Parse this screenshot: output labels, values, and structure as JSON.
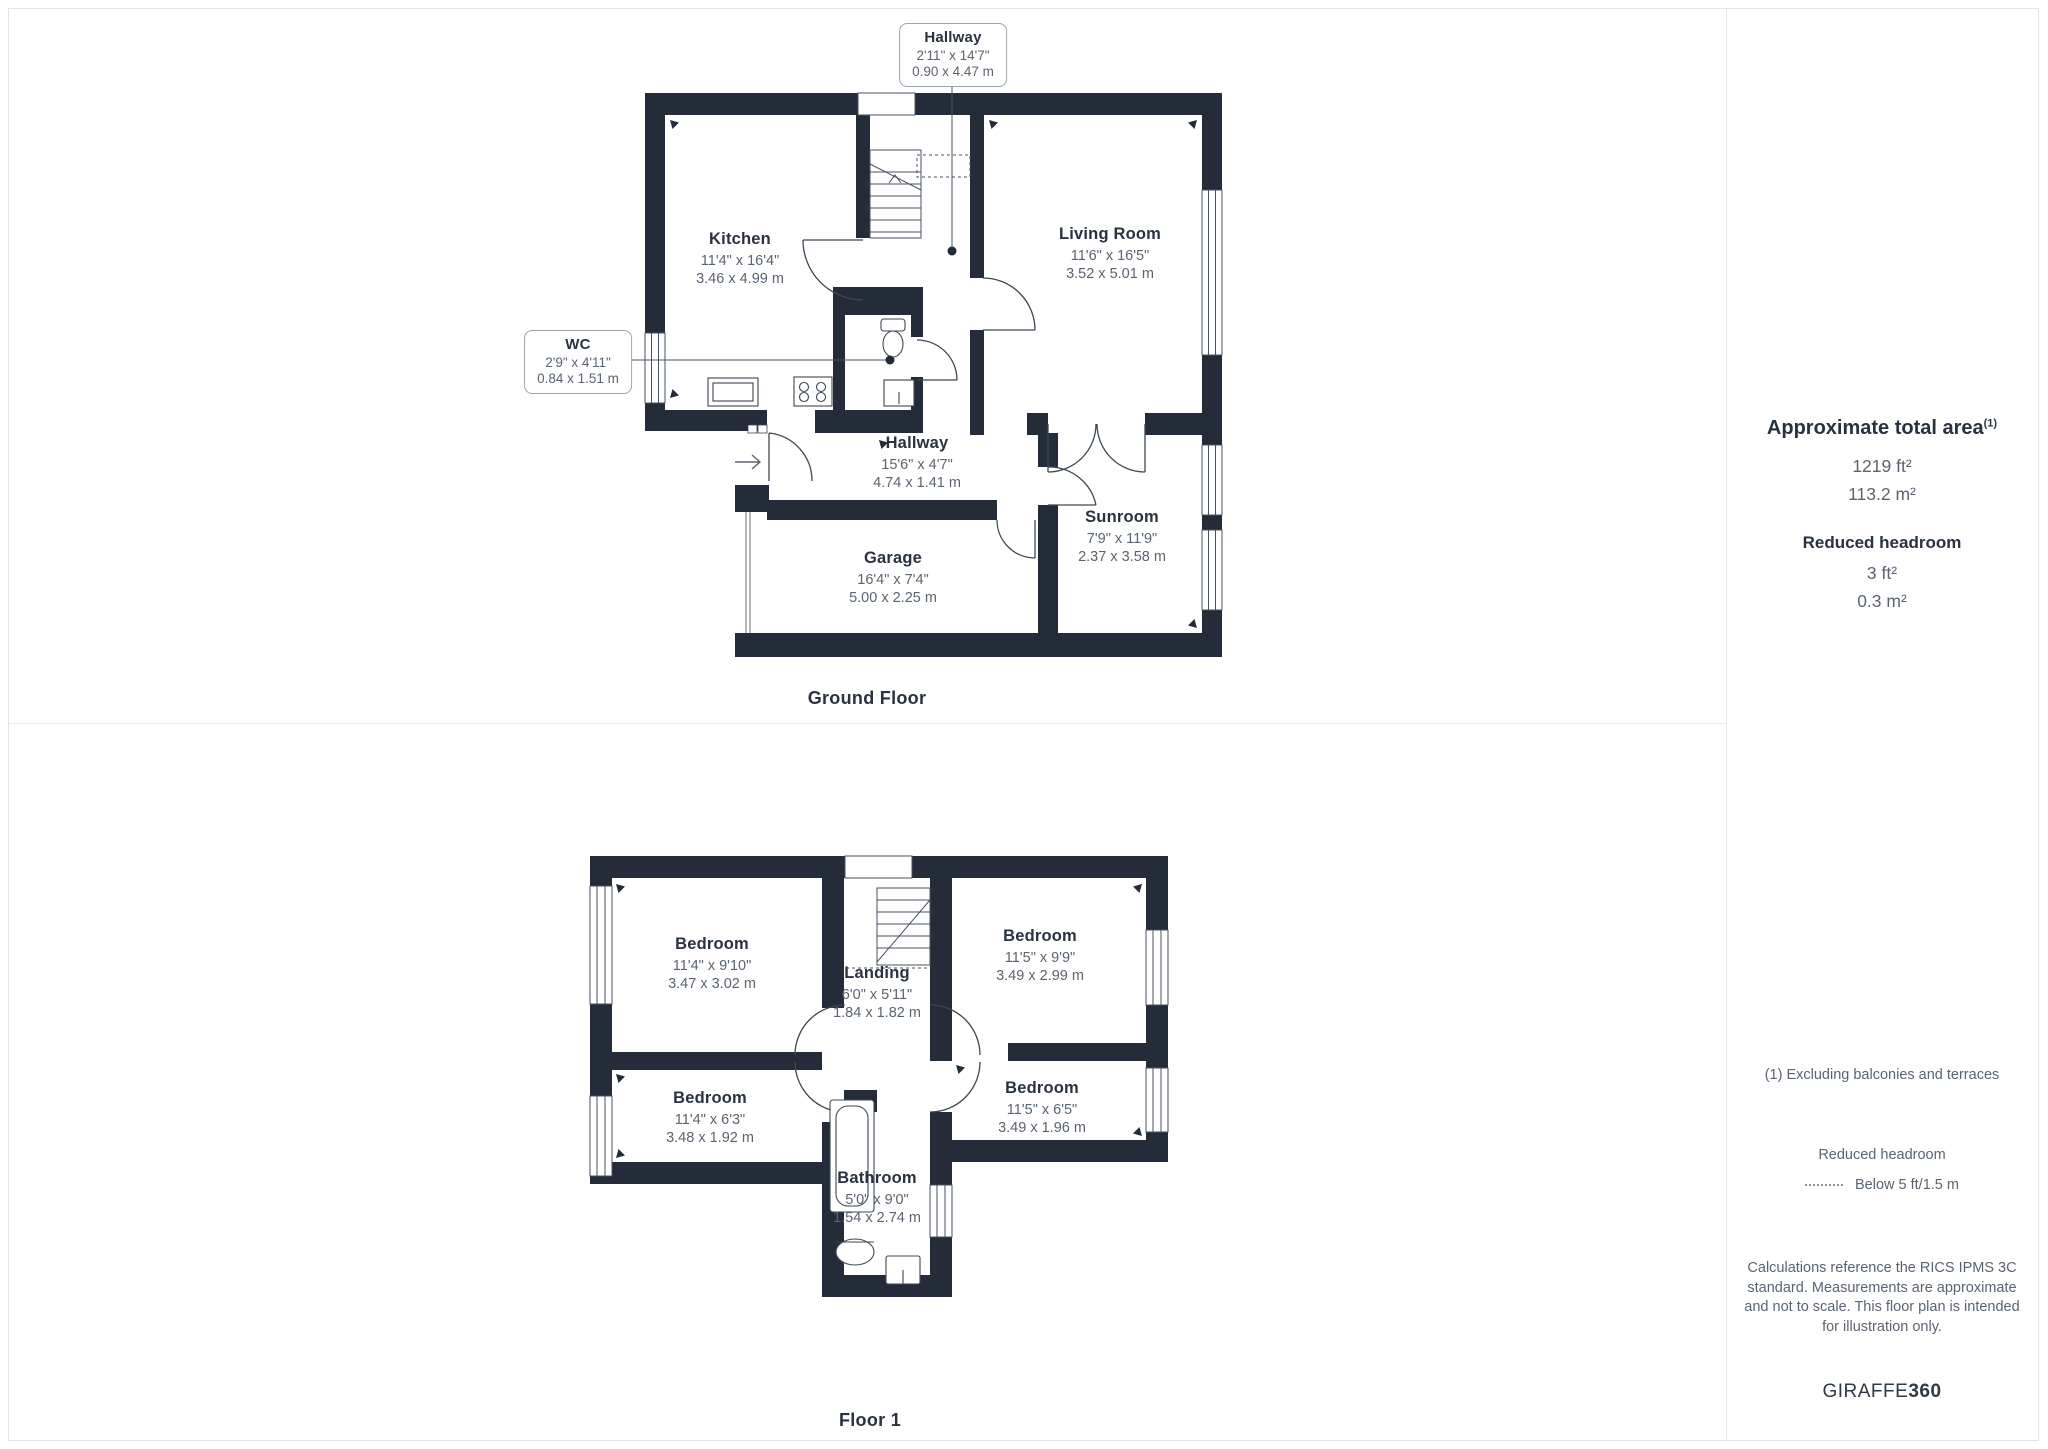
{
  "ground_floor": {
    "title": "Ground Floor",
    "rooms": {
      "kitchen": {
        "name": "Kitchen",
        "imperial": "11'4\" x 16'4\"",
        "metric": "3.46 x 4.99 m"
      },
      "living_room": {
        "name": "Living Room",
        "imperial": "11'6\" x 16'5\"",
        "metric": "3.52 x 5.01 m"
      },
      "hallway": {
        "name": "Hallway",
        "imperial": "15'6\" x 4'7\"",
        "metric": "4.74 x 1.41 m"
      },
      "garage": {
        "name": "Garage",
        "imperial": "16'4\" x 7'4\"",
        "metric": "5.00 x 2.25 m"
      },
      "sunroom": {
        "name": "Sunroom",
        "imperial": "7'9\" x 11'9\"",
        "metric": "2.37 x 3.58 m"
      }
    },
    "callouts": {
      "hallway_upper": {
        "name": "Hallway",
        "imperial": "2'11\" x 14'7\"",
        "metric": "0.90 x 4.47 m"
      },
      "wc": {
        "name": "WC",
        "imperial": "2'9\" x 4'11\"",
        "metric": "0.84 x 1.51 m"
      }
    }
  },
  "floor_1": {
    "title": "Floor 1",
    "rooms": {
      "bedroom_top_left": {
        "name": "Bedroom",
        "imperial": "11'4\" x 9'10\"",
        "metric": "3.47 x 3.02 m"
      },
      "bedroom_top_right": {
        "name": "Bedroom",
        "imperial": "11'5\" x 9'9\"",
        "metric": "3.49 x 2.99 m"
      },
      "landing": {
        "name": "Landing",
        "imperial": "6'0\" x 5'11\"",
        "metric": "1.84 x 1.82 m"
      },
      "bedroom_bottom_left": {
        "name": "Bedroom",
        "imperial": "11'4\" x 6'3\"",
        "metric": "3.48 x 1.92 m"
      },
      "bedroom_bottom_right": {
        "name": "Bedroom",
        "imperial": "11'5\" x 6'5\"",
        "metric": "3.49 x 1.96 m"
      },
      "bathroom": {
        "name": "Bathroom",
        "imperial": "5'0\" x 9'0\"",
        "metric": "1.54 x 2.74 m"
      }
    }
  },
  "sidebar": {
    "total_area_title": "Approximate total area",
    "total_area_footnote_marker": "(1)",
    "total_area_ft": "1219 ft²",
    "total_area_m": "113.2 m²",
    "reduced_headroom_title": "Reduced headroom",
    "reduced_headroom_ft": "3 ft²",
    "reduced_headroom_m": "0.3 m²",
    "footnote": "(1) Excluding balconies and terraces",
    "legend_title": "Reduced headroom",
    "legend_label": "Below 5 ft/1.5 m",
    "disclaimer": "Calculations reference the RICS IPMS 3C standard. Measurements are approximate and not to scale. This floor plan is intended for illustration only.",
    "brand_name": "GIRAFFE",
    "brand_number": "360"
  },
  "colors": {
    "wall": "#242C39",
    "plan_line": "#3E4754",
    "room_name_text": "#2A3240",
    "dimension_text": "#5A6470",
    "divider": "#E7E7E7"
  }
}
